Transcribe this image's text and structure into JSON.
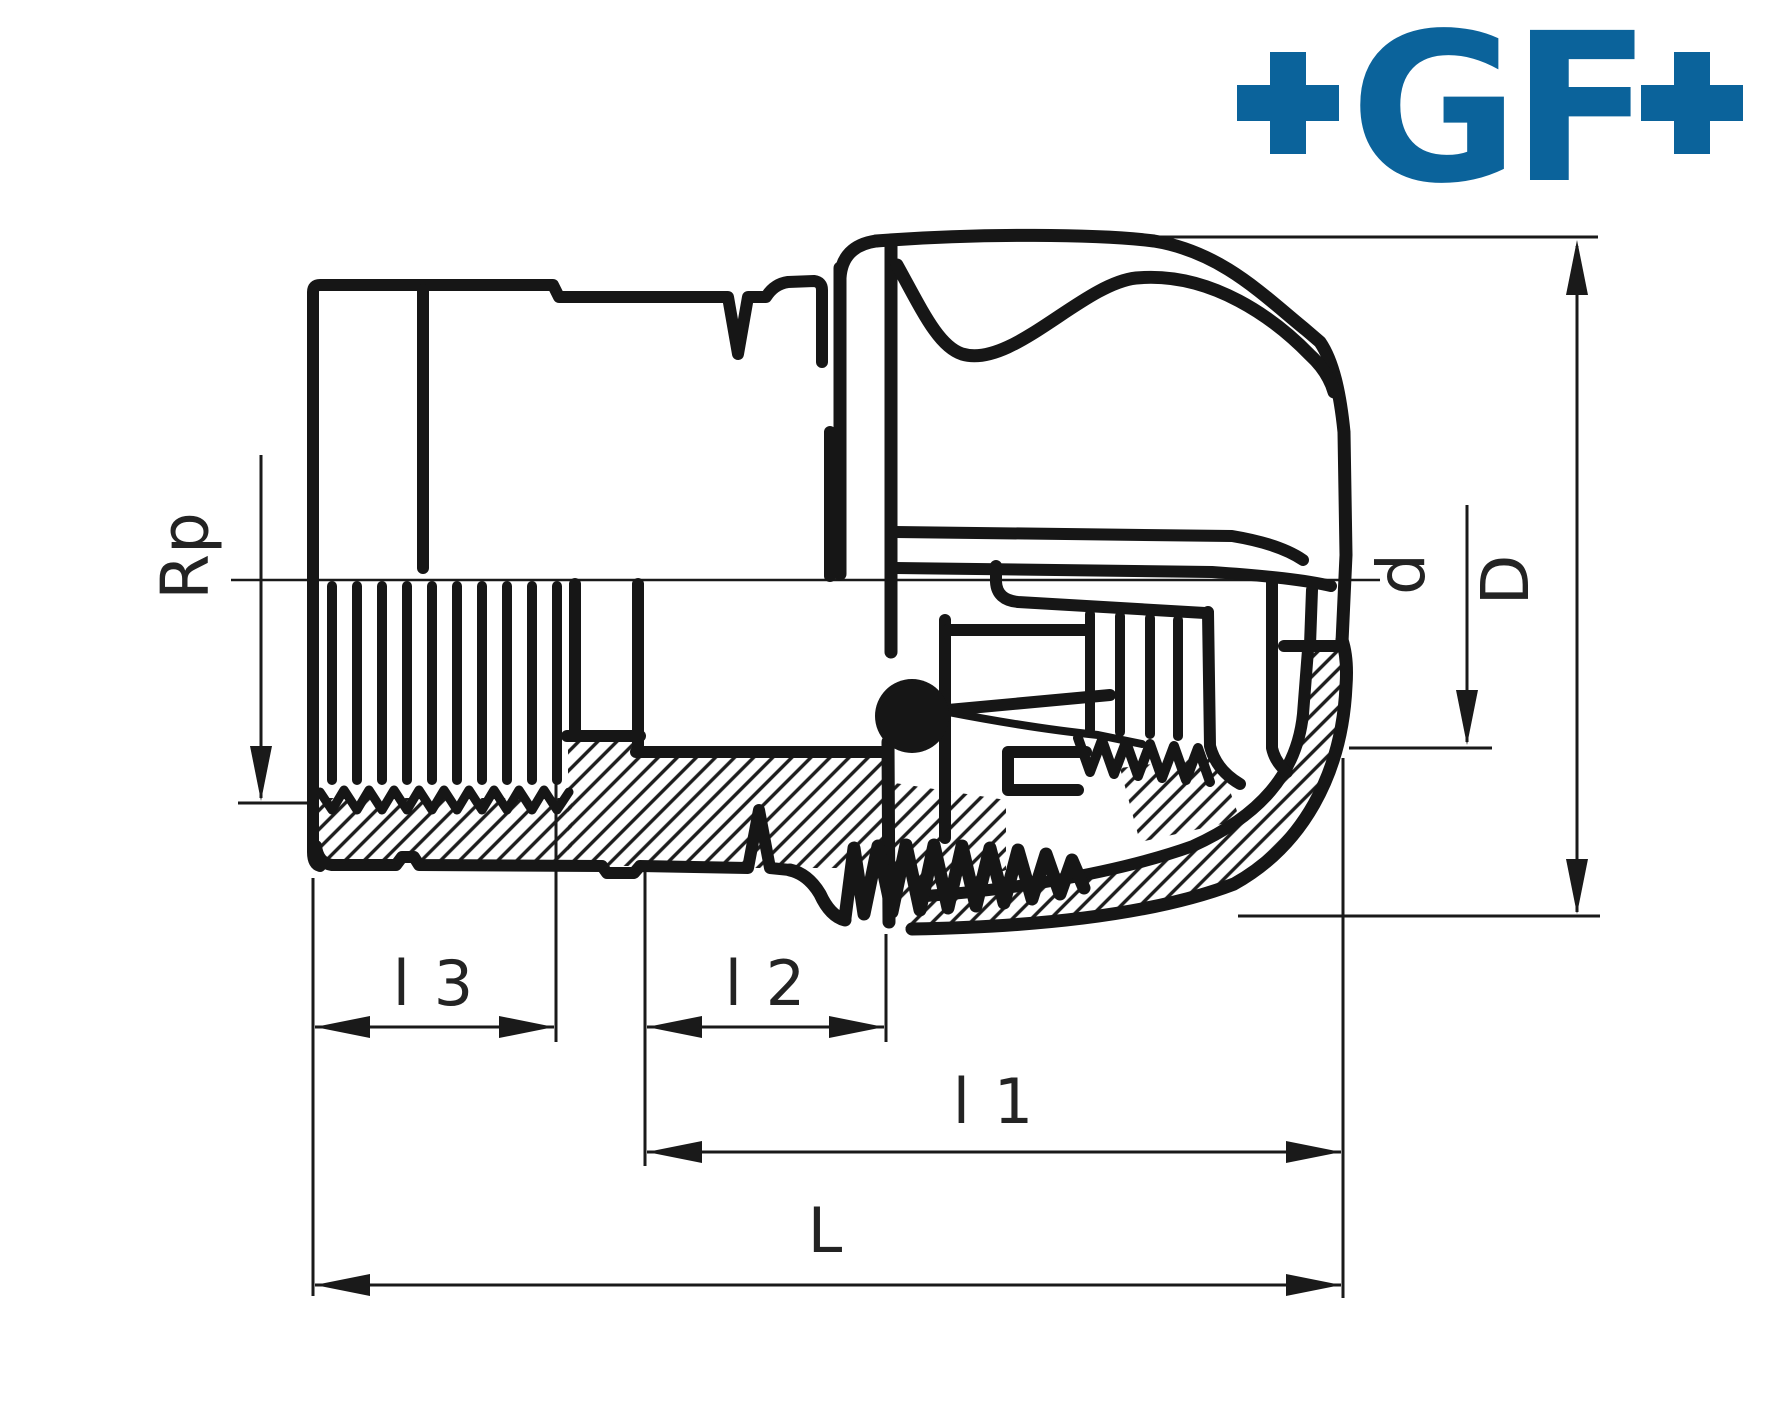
{
  "page": {
    "background": "#ffffff",
    "ink": "#161616"
  },
  "logo": {
    "text": "+GF+",
    "letters": "GF",
    "color": "#0b639b"
  },
  "drawing": {
    "kind": "technical cross-section of pipe fitting",
    "dimension_labels": {
      "rp": "Rp",
      "d": "d",
      "D": "D",
      "l3": "l 3",
      "l2": "l 2",
      "l1": "l 1",
      "L": "L"
    }
  }
}
